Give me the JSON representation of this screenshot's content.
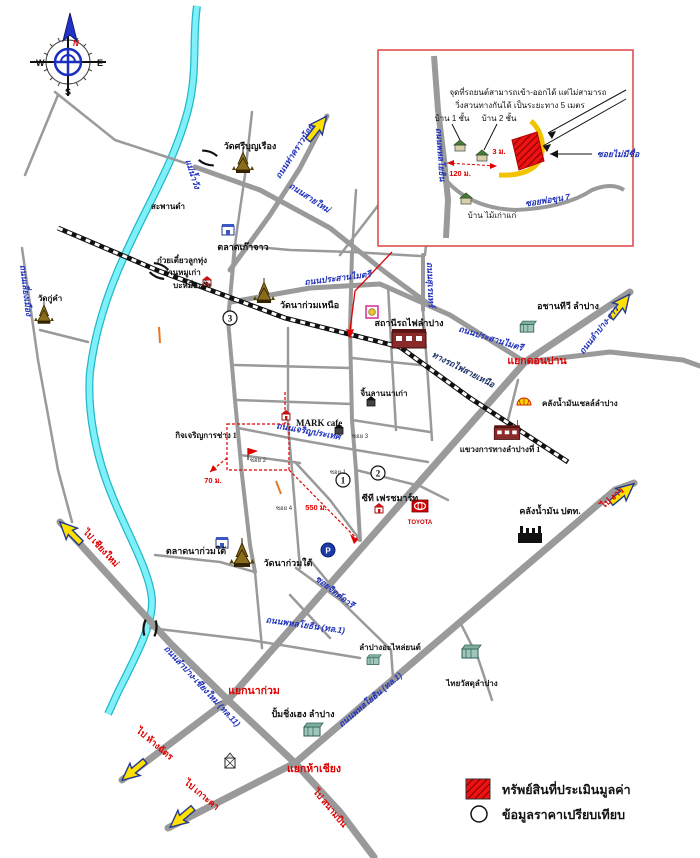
{
  "compass": {
    "n": "N",
    "w": "W",
    "e": "E",
    "s": "S"
  },
  "inset": {
    "note1": "จุดที่รถยนต์สามารถเข้า-ออกได้ แต่ไม่สามารถ",
    "note2": "วิ่งสวนทางกันได้ เป็นระยะทาง 5 เมตร",
    "house1": "บ้าน 1 ชั้น",
    "house2": "บ้าน 2 ชั้น",
    "soi_unnamed": "ซอยไม่มีชื่อ",
    "road_main": "ถนนพหลโยธิน",
    "soi_curve": "ซอยพ่อขุน 7",
    "old_house": "บ้าน ไม้เก่าแก่",
    "d120": "120 ม.",
    "d3": "3 ม."
  },
  "rivers": {
    "wang": "แม่น้ำวัง"
  },
  "roads": {
    "tha_khrao_noi": "ถนนท่าคราวน้อย",
    "sai_mai": "ถนนสายใหม่",
    "prasan_maitri": "ถนนประสานไมตรี",
    "suren": "ถนนสุเรนทร์",
    "lampang_ngao": "ถนนลำปาง-งาว",
    "railway_north": "ทางรถไฟสายเหนือ",
    "phahonyothin": "ถนนพหลโยธิน (ทล.1)",
    "highway11": "ถนนลำปาง-เชียงใหม่ (ทล.11)",
    "charoen_prathet": "ถนนเจริญประเทศ",
    "jit_aree": "ซอยจิตต์อารี",
    "liang_mueang": "ถนนเลี่ยงเมือง",
    "soi1": "ซอย 1",
    "soi2": "ซอย 2",
    "soi3": "ซอย 3",
    "soi4": "ซอย 4"
  },
  "junctions": {
    "don_pan": "แยกดอนปาน",
    "na_kuam": "แยกนาก่วม",
    "ha_chiang": "แยกห้าเชียง"
  },
  "directions": {
    "ngao": "ไป งาว",
    "chiang_mai": "ไป เชียงใหม่",
    "hang_chat": "ไป ห้างฉัตร",
    "ko_kha": "ไป เกาะคา",
    "airport": "ไป สนามบิน"
  },
  "places": {
    "wat_sri_bunruang": "วัดศรีบุญเรือง",
    "bridge_dam": "สะพานดำ",
    "talat_kao_jao": "ตลาดเก๊าจาว",
    "noodle1": "ก๋วยเตี๋ยวลูกทุ่ง",
    "noodle2": "ฮานหมูเก่า",
    "noodle3": "บะหมี่ฮะจั่ง",
    "wat_na_kuam_nuea": "วัดนาก่วมเหนือ",
    "station": "สถานีรถไฟลำปาง",
    "chan_tv": "อชานทีวี ลำปาง",
    "shell_depot": "คลังน้ำมันเชลล์ลำปาง",
    "highway_district": "แขวงการทางลำปางที่ 1",
    "mark_cafe": "MARK cafe",
    "kit_charoen": "กิจเจริญการช่าง 1",
    "jin_lanna": "จิ้นลานนาเก่า",
    "ct_freshmart": "ซีที เฟรชมาร์ท",
    "toyota": "TOYOTA",
    "ptt_depot": "คลังน้ำมัน ปตท.",
    "talat_na_kuam_tai": "ตลาดนาก่วมใต้",
    "wat_na_kuam_tai": "วัดนาก่วมใต้",
    "pump": "ปั้มชิ่งเฮง ลำปาง",
    "spare": "ลำปางอะไหล่ยนต์",
    "thai_wasadu": "ไทยวัสดุลำปาง",
    "wat_ku_kham": "วัดกู่คำ"
  },
  "distances": {
    "d70": "70 ม.",
    "d550": "550 ม."
  },
  "comparables": {
    "c1": "1",
    "c2": "2",
    "c3": "3"
  },
  "legend": {
    "subject": "ทรัพย์สินที่ประเมินมูลค่า",
    "comparable": "ข้อมูลราคาเปรียบเทียบ"
  },
  "colors": {
    "subject_red": "#ee1111",
    "road_gray": "#9a9a9a",
    "river_cyan": "#7ff0f8"
  }
}
